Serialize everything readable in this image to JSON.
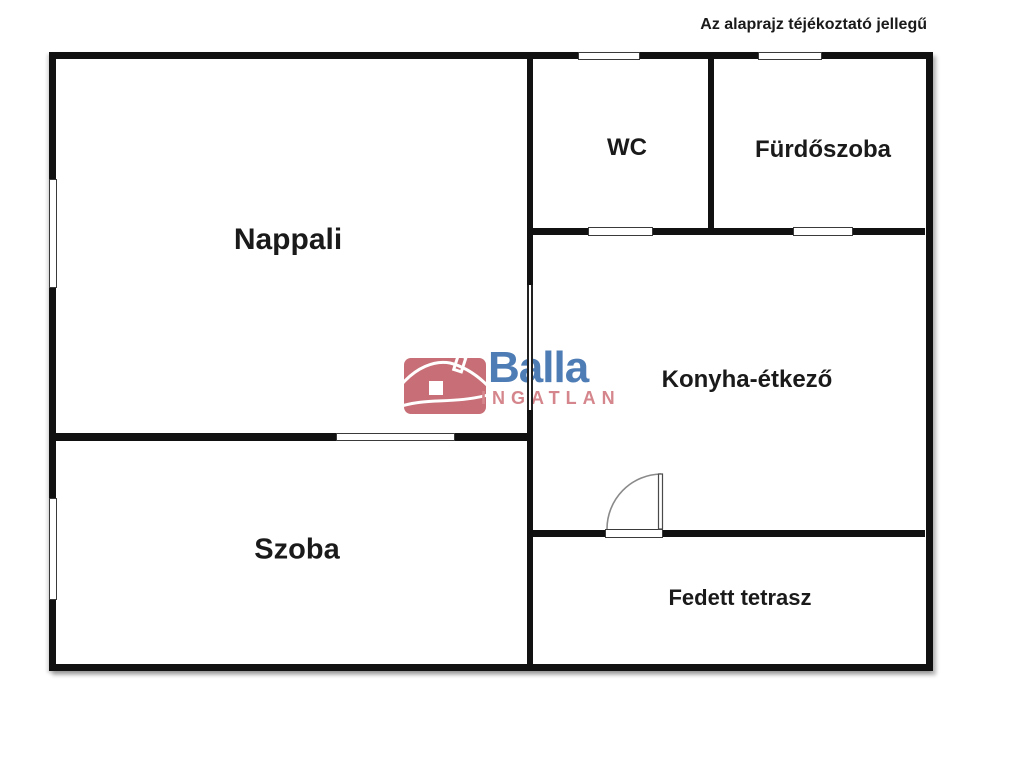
{
  "disclaimer": "Az alaprajz téjékoztató jellegű",
  "rooms": [
    {
      "name": "nappali",
      "label": "Nappali"
    },
    {
      "name": "szoba",
      "label": "Szoba"
    },
    {
      "name": "wc",
      "label": "WC"
    },
    {
      "name": "furdoszoba",
      "label": "Fürdőszoba"
    },
    {
      "name": "konyha-etkezo",
      "label": "Konyha-étkező"
    },
    {
      "name": "fedett-terasz",
      "label": "Fedett tetrasz"
    }
  ],
  "watermark": {
    "brand": "Balla",
    "subtitle": "INGATLAN",
    "icon": "house-icon",
    "colors": {
      "brand": "#4e7cb5",
      "subtitle": "#d5868c",
      "icon_bg": "#c76e76"
    }
  },
  "colors": {
    "wall": "#111111",
    "background": "#ffffff",
    "text": "#1a1a1a"
  }
}
